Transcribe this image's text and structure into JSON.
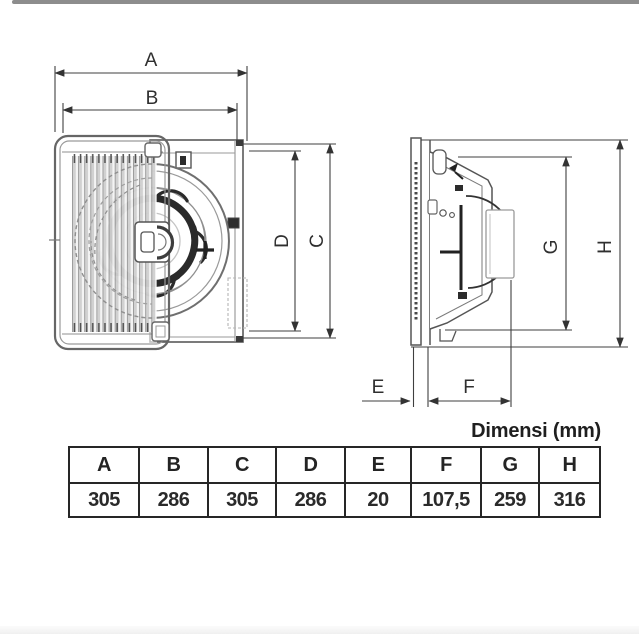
{
  "caption": "Dimensi (mm)",
  "dims": {
    "front": {
      "a": "A",
      "b": "B",
      "c": "C",
      "d": "D"
    },
    "side": {
      "e": "E",
      "f": "F",
      "g": "G",
      "h": "H"
    }
  },
  "table": {
    "headers": [
      "A",
      "B",
      "C",
      "D",
      "E",
      "F",
      "G",
      "H"
    ],
    "values": [
      "305",
      "286",
      "305",
      "286",
      "20",
      "107,5",
      "259",
      "316"
    ]
  },
  "colors": {
    "dimension_line": "#3f3f3f",
    "drawing_line": "#565656",
    "dark_detail": "#2a2a2a",
    "light_gray": "#b5b5b5",
    "text": "#2a2a2a",
    "table_border": "#262626",
    "top_bar": "#8d8d8d"
  }
}
